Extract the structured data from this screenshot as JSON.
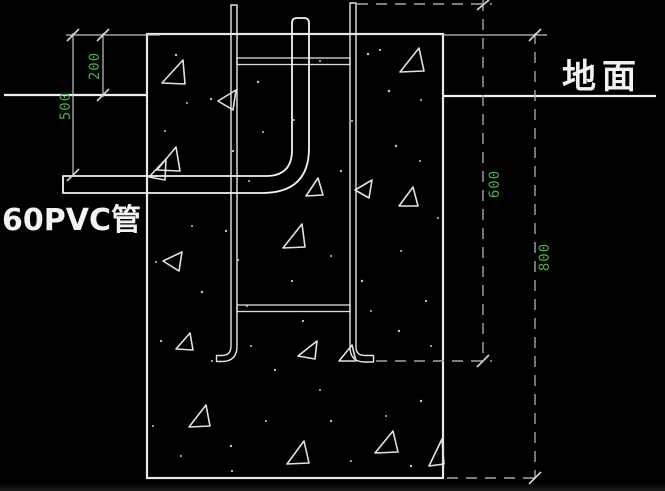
{
  "drawing": {
    "labels": {
      "ground": "地面",
      "pipe": "60PVC管"
    },
    "dims": {
      "d200": "200",
      "d500": "500",
      "d600": "600",
      "d800": "800"
    },
    "colors": {
      "background": "#000000",
      "line": "#e8e8e8",
      "dim_text": "#46b046",
      "label_text": "#f2f2f2"
    }
  }
}
